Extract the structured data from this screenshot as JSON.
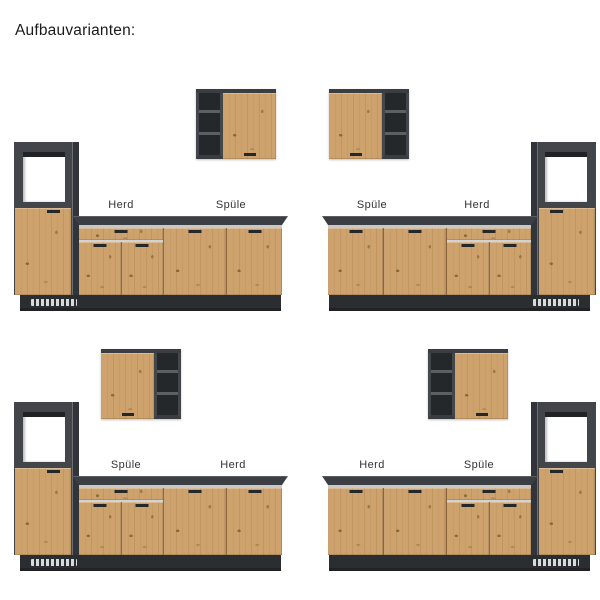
{
  "page": {
    "title": "Aufbauvarianten:"
  },
  "colors": {
    "background": "#ffffff",
    "wood_front": "#cda26d",
    "carcass_gray": "#42464b",
    "countertop": "#3b3f43",
    "counter_front_edge": "#c7c8ca",
    "plinth": "#2b2e31",
    "niche_interior": "#ffffff",
    "label_text": "#323234",
    "title_text": "#1b1b1d"
  },
  "variants": [
    {
      "name": "top-left",
      "tall_cabinet_side": "left",
      "wall_cabinet_door_side": "right",
      "label_left": "Herd",
      "label_right": "Spüle"
    },
    {
      "name": "top-right",
      "tall_cabinet_side": "right",
      "wall_cabinet_door_side": "left",
      "label_left": "Spüle",
      "label_right": "Herd"
    },
    {
      "name": "bottom-left",
      "tall_cabinet_side": "left",
      "wall_cabinet_door_side": "left",
      "label_left": "Spüle",
      "label_right": "Herd"
    },
    {
      "name": "bottom-right",
      "tall_cabinet_side": "right",
      "wall_cabinet_door_side": "right",
      "label_left": "Herd",
      "label_right": "Spüle"
    }
  ]
}
